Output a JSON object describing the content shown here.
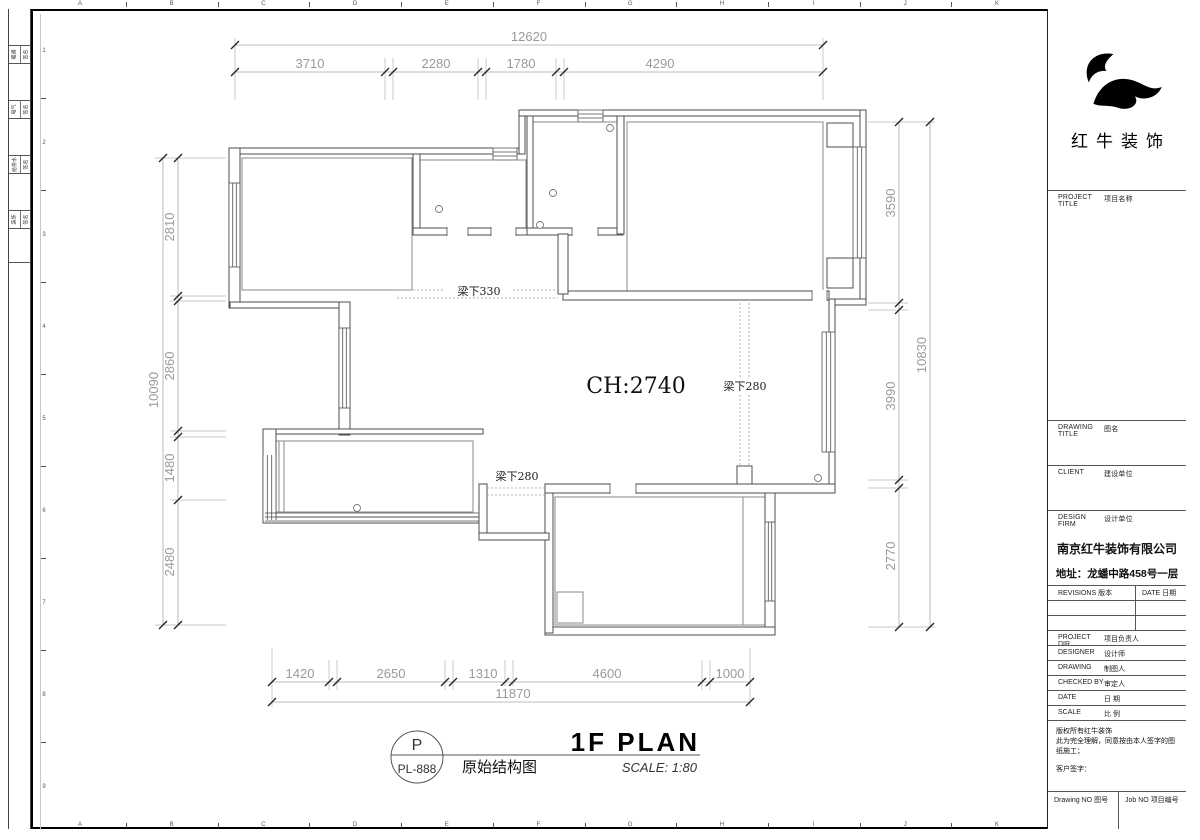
{
  "sheet": {
    "background": "#ffffff",
    "wall_line_color": "#4d4d4d",
    "dim_color": "#9a9a9a",
    "grid_letters": [
      "A",
      "B",
      "C",
      "D",
      "E",
      "F",
      "G",
      "H",
      "I",
      "J",
      "K"
    ],
    "grid_numbers": [
      "1",
      "2",
      "3",
      "4",
      "5",
      "6",
      "7",
      "8",
      "9"
    ],
    "edge_strip_rows": [
      {
        "discipline": "暖通",
        "field": "签名"
      },
      {
        "discipline": "电气",
        "field": "签名"
      },
      {
        "discipline": "给排水",
        "field": "签名"
      },
      {
        "discipline": "装饰",
        "field": "签名"
      }
    ]
  },
  "plan": {
    "ceiling_label": "CH:2740",
    "beam_330": "梁下330",
    "beam_280_right": "梁下280",
    "beam_280_left": "梁下280",
    "dims": {
      "top": {
        "total": "12620",
        "segments": [
          "3710",
          "2280",
          "1780",
          "4290"
        ]
      },
      "bottom": {
        "total": "11870",
        "segments": [
          "1420",
          "2650",
          "1310",
          "4600",
          "1000"
        ]
      },
      "left": {
        "total": "10090",
        "segments": [
          "2810",
          "2860",
          "1480",
          "2480"
        ]
      },
      "right": {
        "total": "10830",
        "segments": [
          "3590",
          "3990",
          "2770"
        ]
      }
    }
  },
  "drawing_title": {
    "bubble_letter": "P",
    "bubble_code": "PL-888",
    "title_en": "1F PLAN",
    "title_cn": "原始结构图",
    "scale_note": "SCALE: 1:80"
  },
  "titleblock": {
    "logo_text": "红牛装饰",
    "project_title": {
      "en": "PROJECT TITLE",
      "cn": "项目名称"
    },
    "drawing_title": {
      "en": "DRAWING TITLE",
      "cn": "图名"
    },
    "client": {
      "en": "CLIENT",
      "cn": "建设单位"
    },
    "design_firm": {
      "en": "DESIGN FIRM",
      "cn": "设计单位"
    },
    "firm_name": "南京红牛装饰有限公司",
    "firm_address": "地址：龙蟠中路458号一层",
    "revisions": {
      "en": "REVISIONS",
      "cn": "版本"
    },
    "rev_date": {
      "en": "DATE",
      "cn": "日期"
    },
    "rows": [
      {
        "en": "PROJECT DIR",
        "cn": "项目负责人"
      },
      {
        "en": "DESIGNER",
        "cn": "设计师"
      },
      {
        "en": "DRAWING",
        "cn": "制图人"
      },
      {
        "en": "CHECKED BY",
        "cn": "审定人"
      },
      {
        "en": "DATE",
        "cn": "日  期"
      },
      {
        "en": "SCALE",
        "cn": "比  例"
      }
    ],
    "notes_line1": "版权所有红牛装饰",
    "notes_line2": "此为完全理解，同意按由本人签字的图纸施工；",
    "notes_sign": "客户签字：",
    "drawing_no": {
      "en": "Drawing NO",
      "cn": "图号"
    },
    "job_no": {
      "en": "Job NO",
      "cn": "项目编号"
    }
  }
}
